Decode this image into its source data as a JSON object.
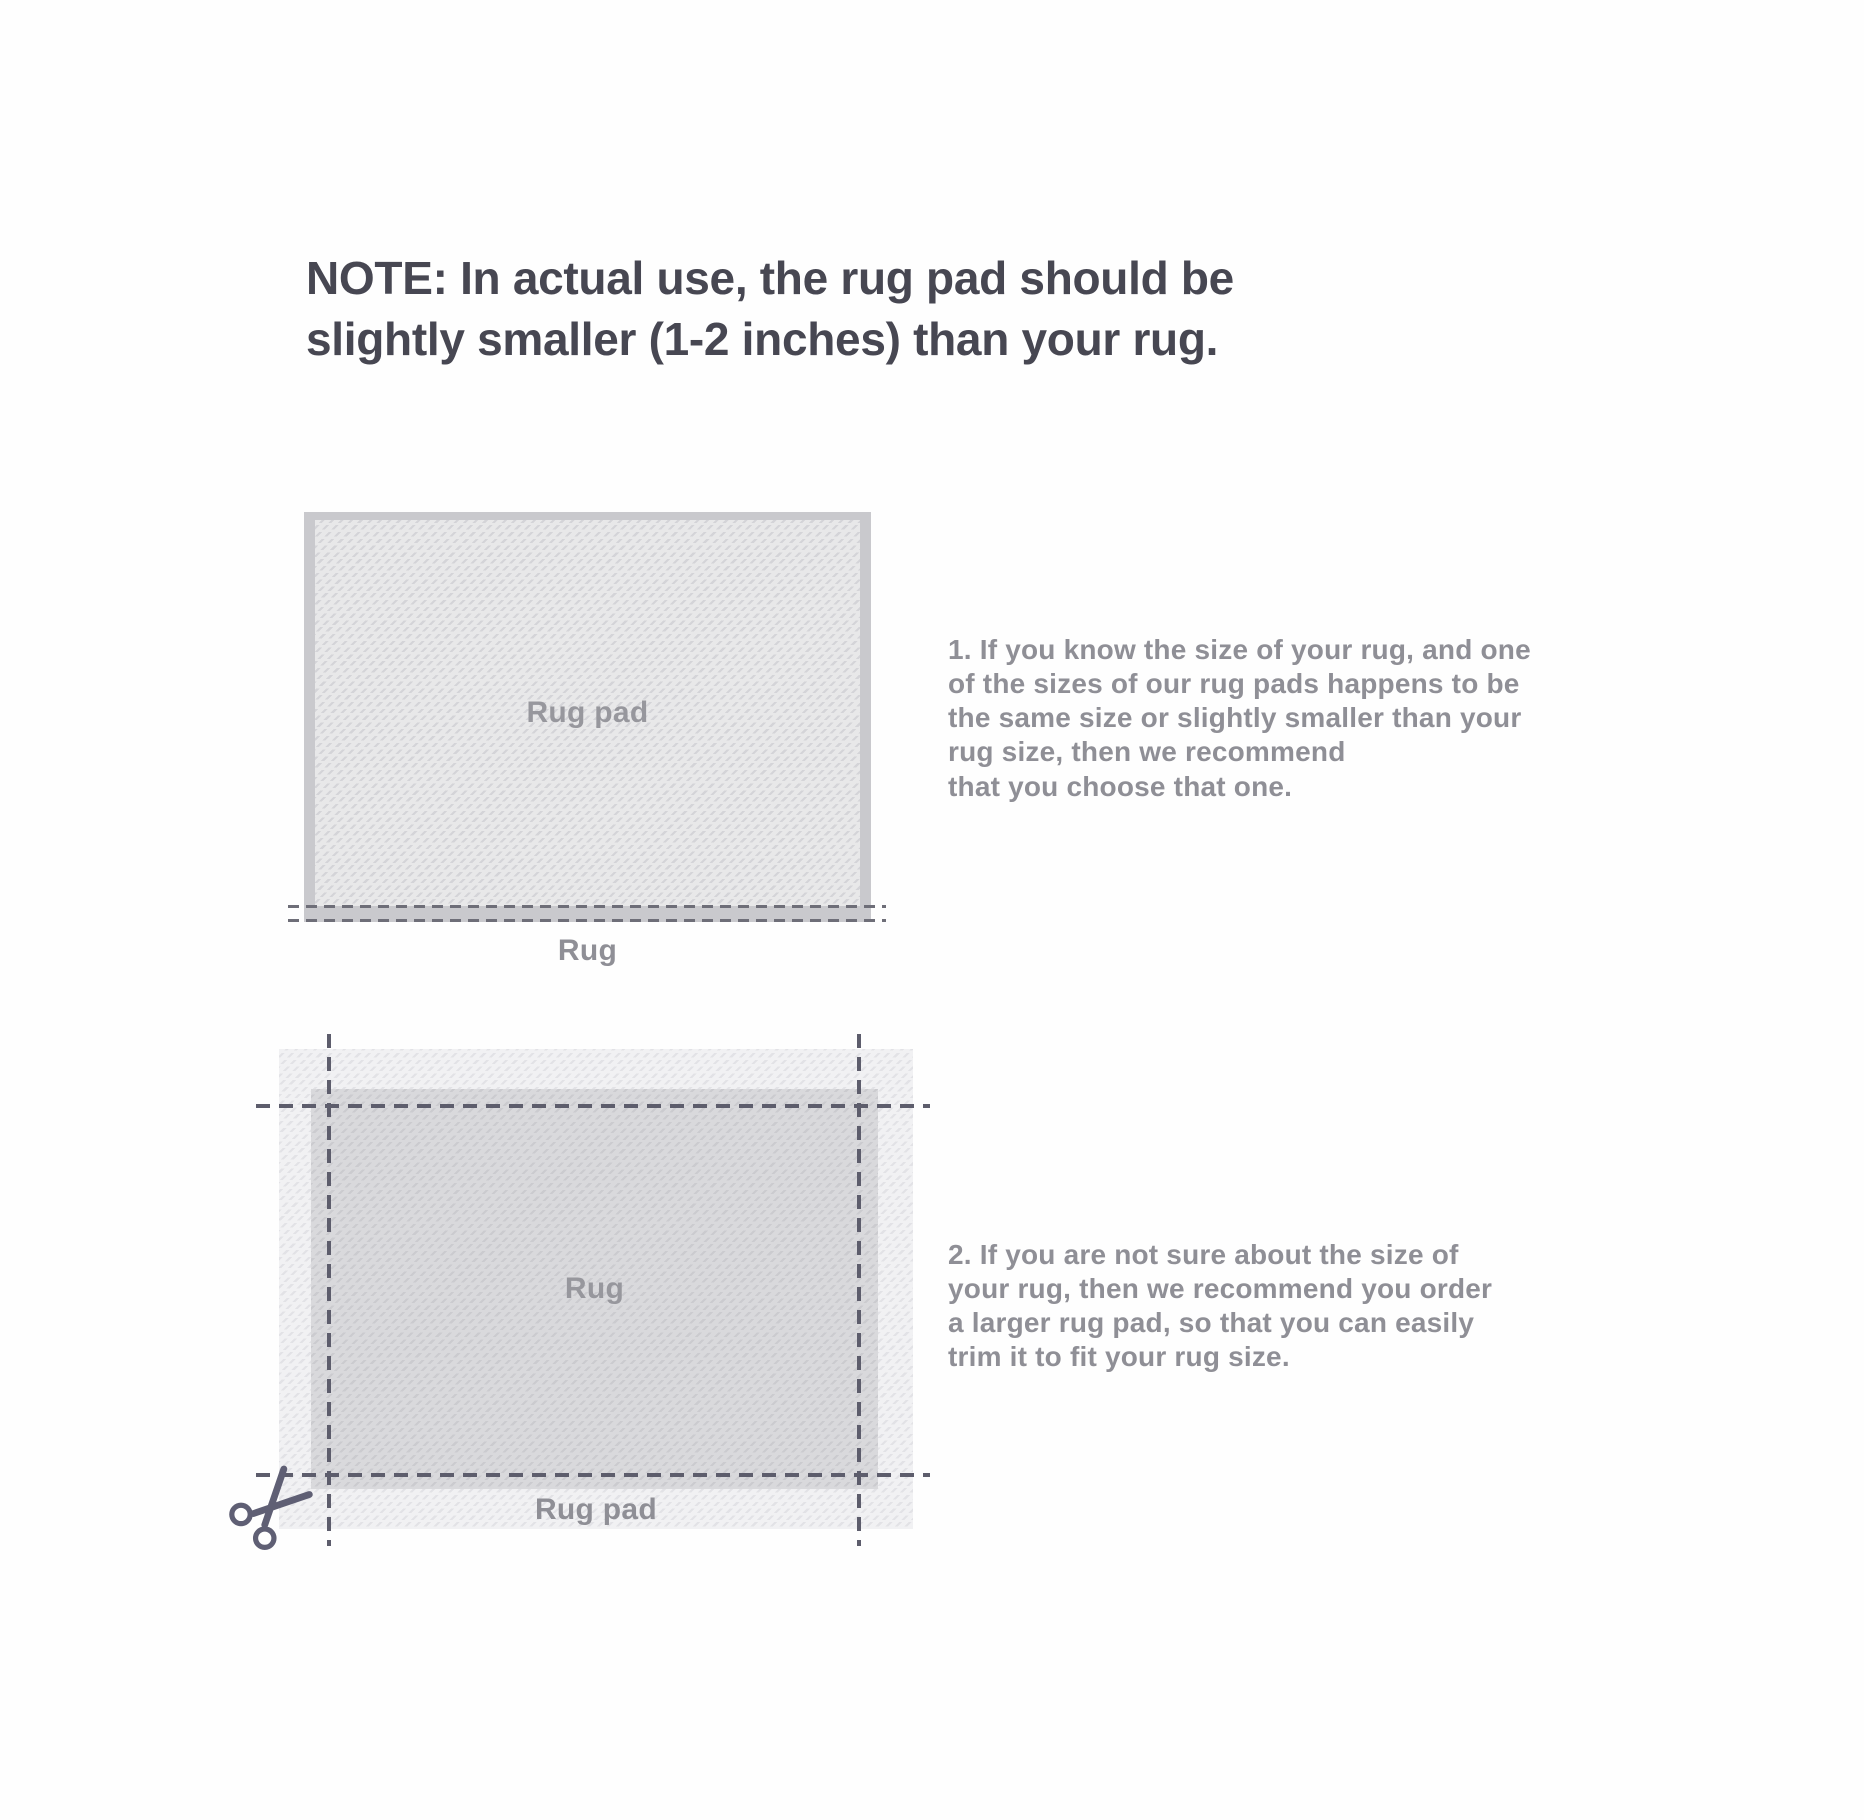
{
  "title": "NOTE: In actual use, the rug pad should be\nslightly smaller (1-2 inches) than your rug.",
  "steps": {
    "step1": "1. If you know the size of your rug, and one\nof the sizes of our rug pads happens to be\nthe same size or slightly smaller than your\nrug size, then we recommend\nthat you choose that one.",
    "step2": "2. If you are not sure about the size of\nyour rug, then we recommend you order\na larger rug pad, so that you can easily\ntrim it to fit your rug size."
  },
  "diagram1": {
    "pad_label": "Rug pad",
    "rug_label": "Rug"
  },
  "diagram2": {
    "rug_label": "Rug",
    "pad_label": "Rug pad"
  },
  "icons": {
    "scissors": "scissors-icon"
  },
  "colors": {
    "background": "#fefefe",
    "title_text": "#474752",
    "body_text": "#8f8f96",
    "diagram_label_text": "#97979d",
    "rug_solid": "#c9c9cd",
    "pad1_base": "#e8e8e9",
    "pad1_hatch": "#d4d4d8",
    "pad2_base": "#f1f1f3",
    "pad2_hatch": "#e2e2e6",
    "rug2_base": "#d9d9dc",
    "rug2_hatch": "#cbcbcf",
    "dash_line_d1": "#6e6e78",
    "dash_line_d2": "#5d5d6c",
    "scissors": "#5f5f74"
  }
}
